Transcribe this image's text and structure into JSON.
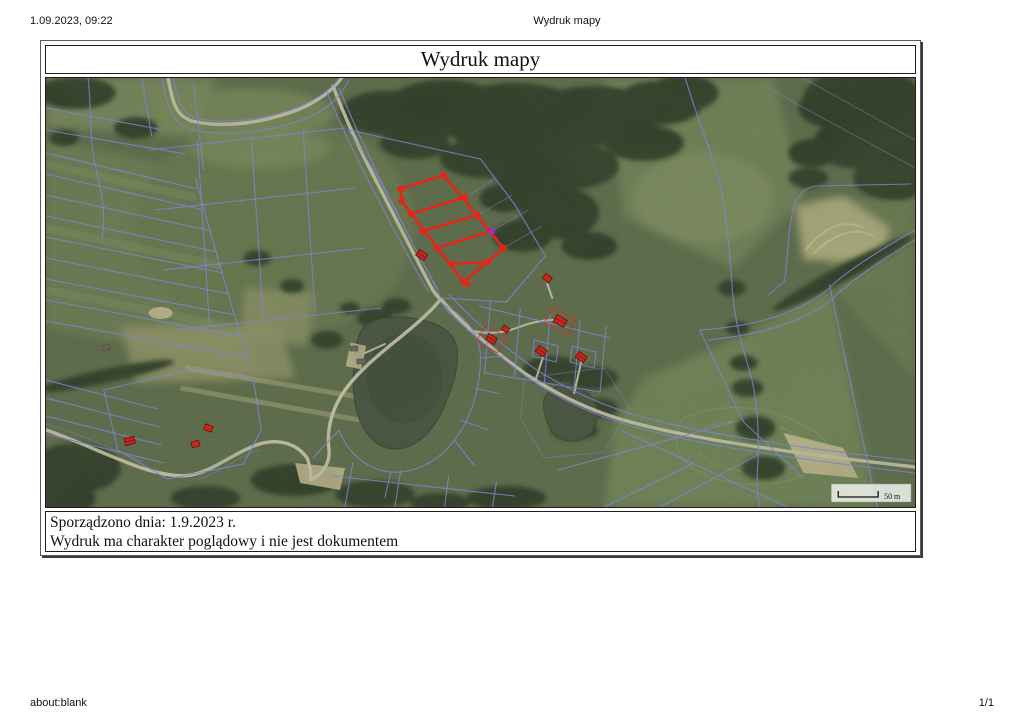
{
  "page": {
    "print_header": {
      "datetime": "1.09.2023, 09:22",
      "document_title": "Wydruk mapy"
    },
    "print_footer": {
      "source": "about:blank",
      "page_number": "1/1"
    }
  },
  "sheet": {
    "title": "Wydruk mapy",
    "footnote_line1": "Sporządzono dnia: 1.9.2023 r.",
    "footnote_line2": "Wydruk ma charakter poglądowy i nie jest dokumentem"
  },
  "map": {
    "scale_label": "50 m",
    "kind": "aerial orthophoto with cadastral parcel boundary overlay",
    "highlight": "group of parcels outlined in red with vertex markers and one magenta point"
  },
  "colors": {
    "field_base": "#5c6a4a",
    "forest": "#2e3a27",
    "water": "#454f3e",
    "road": "#c2bda4",
    "parcel_line": "#8184e2",
    "highlight_red": "#e8241a",
    "vertex_magenta": "#a22ad0",
    "building_red": "#c4281c",
    "scalebar_bg": "#eceee7"
  }
}
